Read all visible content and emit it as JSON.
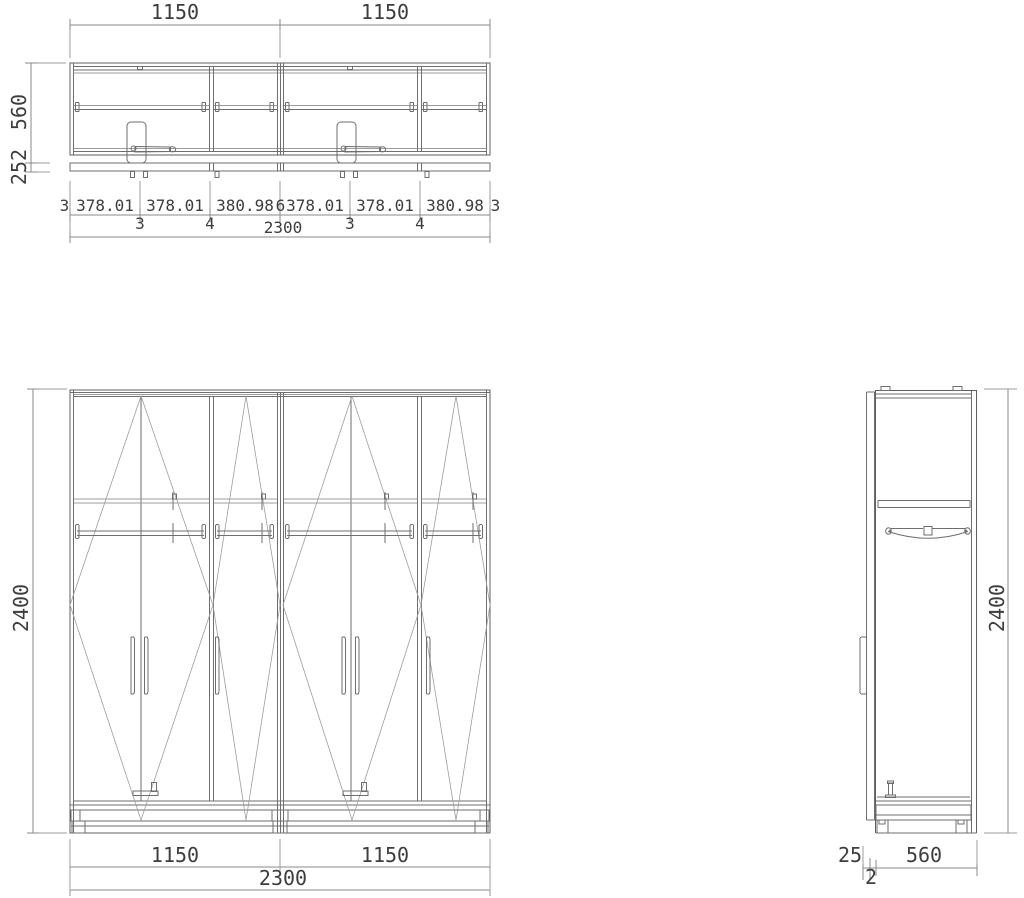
{
  "plan_view": {
    "dim_width_left": "1150",
    "dim_width_right": "1150",
    "dim_depth": "560",
    "dim_front_offset": "252",
    "door_chain": [
      "3",
      "378.01",
      "378.01",
      "380.98",
      "6",
      "378.01",
      "378.01",
      "380.98",
      "3"
    ],
    "gap_chain": [
      "3",
      "4",
      "3",
      "4"
    ],
    "dim_total_width": "2300"
  },
  "front_view": {
    "dim_height": "2400",
    "dim_module_left": "1150",
    "dim_module_right": "1150",
    "dim_total_width": "2300"
  },
  "side_view": {
    "dim_height": "2400",
    "dim_handle_depth": "25",
    "dim_door_gap": "2",
    "dim_body_depth": "560"
  },
  "colors": {
    "background": "#ffffff",
    "line": "#6e6e6e",
    "line_faint": "#9d9d9d",
    "dim_line": "#8a8a8a",
    "text": "#3d3d3d"
  }
}
